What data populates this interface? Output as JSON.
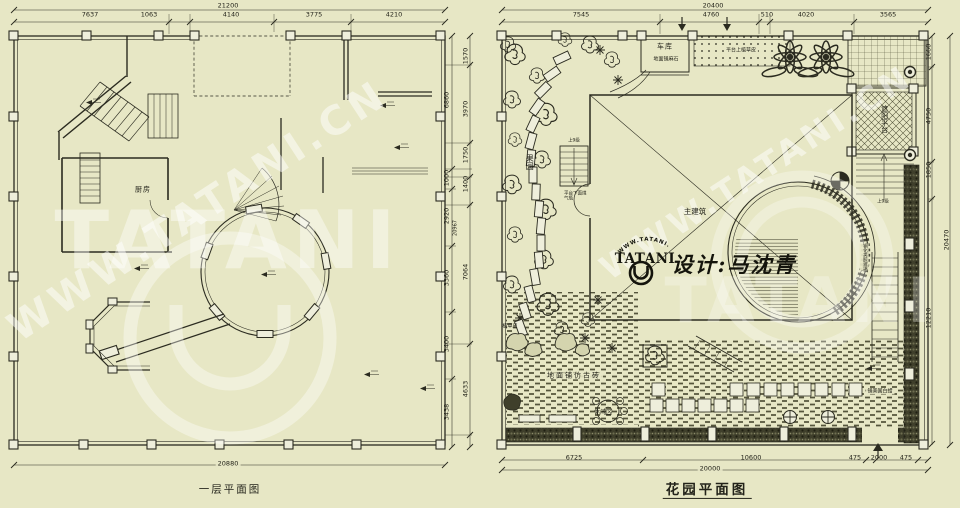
{
  "colors": {
    "background": "#e7e7c5",
    "line": "#2b2b20",
    "watermark": "#ffffff",
    "text": "#23231a"
  },
  "left_plan": {
    "title": "一层平面图",
    "dimensions": {
      "top_total": "21200",
      "top": [
        "7637",
        "1063",
        "4140",
        "3775",
        "4210"
      ],
      "right_outer": [
        "6860",
        "1000",
        "2920",
        "3360",
        "3400",
        "3438"
      ],
      "right_inner": [
        "1570",
        "3970",
        "1750",
        "1400",
        "7064",
        "4633"
      ],
      "right_overall": "20967",
      "bottom_total": "20880"
    },
    "labels": {
      "kitchen": "厨房"
    }
  },
  "right_plan": {
    "title": "花园平面图",
    "dimensions": {
      "top_total": "20400",
      "top": [
        "7545",
        "4760",
        "510",
        "4020",
        "3565"
      ],
      "right_inner": [
        "1660",
        "4750",
        "1850",
        "12210"
      ],
      "right_total": "20470",
      "bottom": [
        "6725",
        "10600",
        "475",
        "2000",
        "475"
      ],
      "bottom_total": "20000"
    },
    "labels": {
      "garage": "车库",
      "garage_floor": "地面铺麻石",
      "platform_grass": "平台上植草皮",
      "orchard": "果园",
      "stairs_up": "上9级",
      "gas_note": "平台下面煤气瓶",
      "main_building": "主建筑",
      "shade_platform": "遮阳平台",
      "glass": "钢化夹胶玻璃",
      "ash_paving": "铺美国白蜡",
      "lawn": "植草皮",
      "brick_paving": "地面铺仿古砖",
      "leisure": "休闲区"
    }
  },
  "branding": {
    "logo_text": "TATANI",
    "logo_arc_text": "WWW.TATANI.CN",
    "designer": "设计:马沈青",
    "watermark_diagonal": "WWW.TATANI.CN",
    "watermark_large": "TATANI"
  }
}
